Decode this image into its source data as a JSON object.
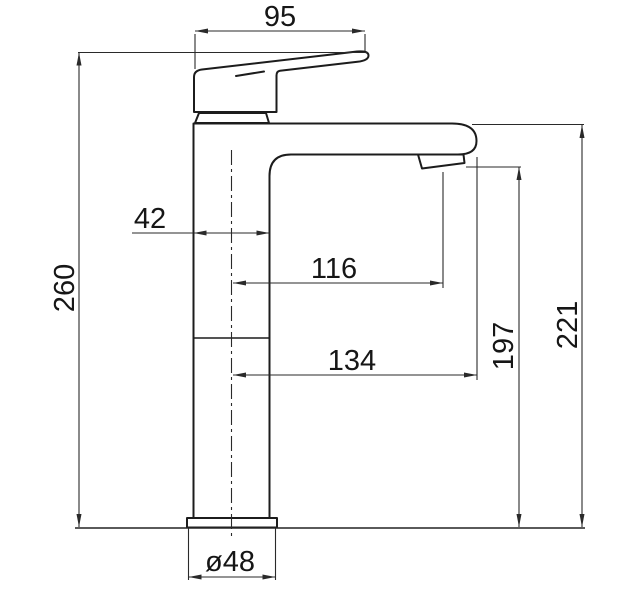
{
  "drawing": {
    "kind": "single-lever basin mixer tap, side elevation with dimensions",
    "colors": {
      "line": "#1c1c1c",
      "background": "#ffffff"
    },
    "dimensions": {
      "handle_length": "95",
      "body_width": "42",
      "overall_height": "260",
      "spout_reach": "116",
      "overall_reach": "134",
      "outlet_height": "197",
      "spout_top_height": "221",
      "base_diameter": "ø48"
    }
  }
}
